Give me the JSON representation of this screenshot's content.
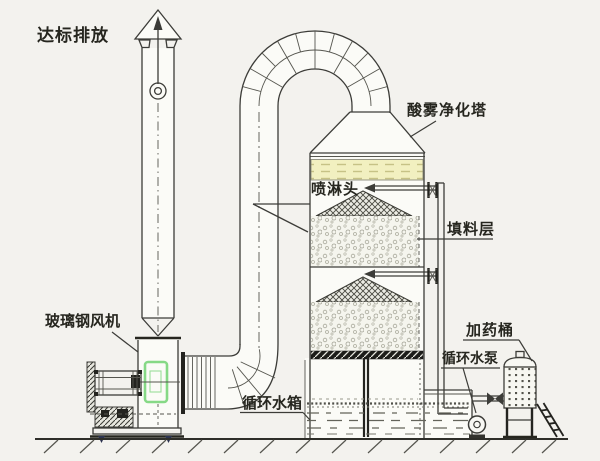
{
  "diagram": {
    "labels": {
      "discharge": "达标排放",
      "tower": "酸雾净化塔",
      "spray_head": "喷淋头",
      "packing_layer": "填料层",
      "dosing_barrel": "加药桶",
      "circulating_pump": "循环水泵",
      "circulating_tank": "循环水箱",
      "frp_fan": "玻璃钢风机"
    },
    "colors": {
      "line": "#3c3c38",
      "fan_highlight_green": "#86d986",
      "demister_band_yellow": "#f2f0c0",
      "background": "#f3f2ee"
    }
  }
}
